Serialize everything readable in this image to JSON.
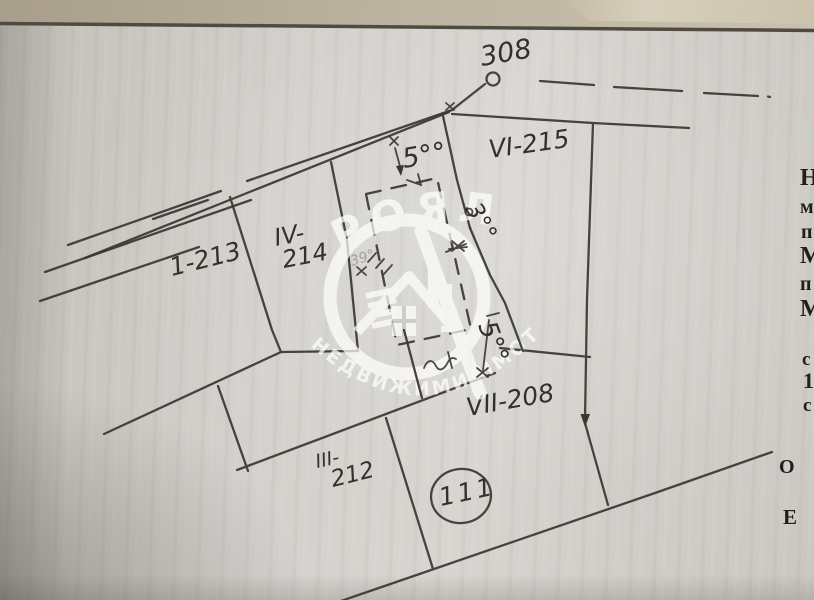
{
  "plan": {
    "road_number": "308",
    "parcels": [
      {
        "label": "1-213"
      },
      {
        "label_line1": "IV-",
        "label_line2": "214"
      },
      {
        "label": "VI-215"
      },
      {
        "label": "VII-208"
      },
      {
        "label_line1": "III-",
        "label_line2": "212"
      }
    ],
    "circled_number": "111",
    "measurements": [
      {
        "label": "5°°",
        "value": "5.00",
        "position": "top"
      },
      {
        "label": "3°°",
        "value": "3.00",
        "position": "middle"
      },
      {
        "label": "5°°",
        "value": "5.00",
        "position": "bottom"
      }
    ]
  },
  "watermark": {
    "brand": "РОЯЛ",
    "tagline": "НЕДВИЖИМИ ИМОТИ",
    "angle_mark": "39°"
  },
  "edge_text": {
    "letters": [
      "Н",
      "м",
      "п",
      "М",
      "п",
      "М",
      "с",
      "1",
      "с",
      "О",
      "Е"
    ]
  },
  "colors": {
    "paper": "#d3d1cc",
    "desk": "#b3a996",
    "ink": "#3a3732",
    "watermark": "#ffffff"
  }
}
